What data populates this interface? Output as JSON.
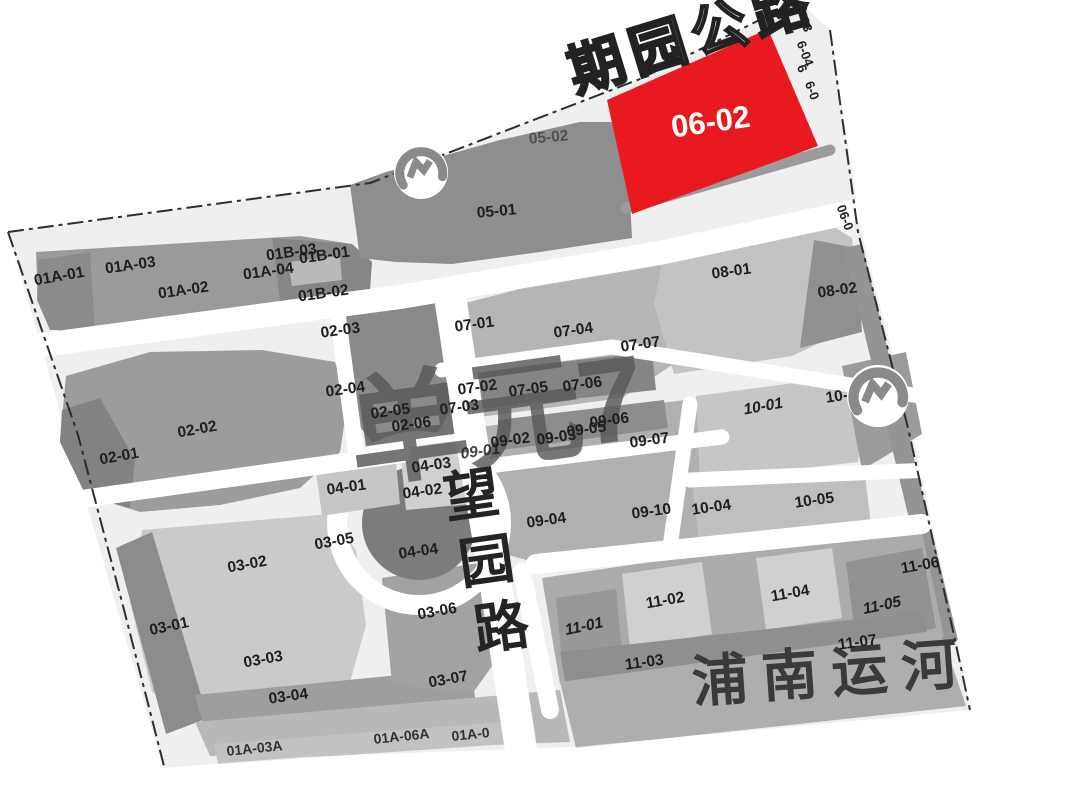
{
  "map_title": {
    "unit": "单元7",
    "canal": "浦南运河",
    "top_road": "期园公路",
    "v_road": [
      "望",
      "园",
      "路"
    ]
  },
  "highlight_parcel": {
    "id": "06-02",
    "color": "#e91a1f"
  },
  "labels": [
    "01A-01",
    "01A-03",
    "01A-02",
    "01A-04",
    "01B-03",
    "01B-01",
    "01B-02",
    "02-03",
    "02-04",
    "02-05",
    "02-06",
    "02-02",
    "02-01",
    "05-01",
    "05-02",
    "07-01",
    "07-04",
    "07-07",
    "07-02",
    "07-05",
    "07-06",
    "07-03",
    "08-01",
    "08-02",
    "09-01",
    "09-02",
    "09-03",
    "09-05",
    "09-06",
    "09-07",
    "09-04",
    "09-10",
    "10-01",
    "10-02",
    "10-04",
    "10-05",
    "04-03",
    "04-02",
    "04-01",
    "04-04",
    "03-05",
    "03-02",
    "03-01",
    "03-03",
    "03-04",
    "03-06",
    "03-07",
    "11-01",
    "11-02",
    "11-03",
    "11-04",
    "11-05",
    "11-07",
    "11-06"
  ],
  "edge_labels": [
    "03",
    "6-04",
    "6",
    "6-0",
    "06-0"
  ],
  "clipped_labels": [
    "01A-03A",
    "01A-06A",
    "01A-0"
  ],
  "icons": {
    "metro_station": "shanghai-metro-logo"
  },
  "colors": {
    "boundary": "#2e2e2e",
    "road": "#ffffff"
  }
}
